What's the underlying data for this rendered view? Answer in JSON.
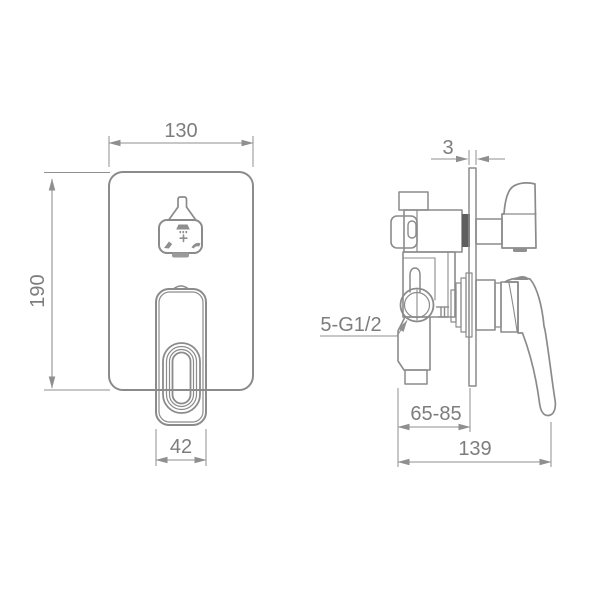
{
  "dimensions": {
    "plate_width": "130",
    "plate_height": "190",
    "handle_width": "42",
    "plate_thickness": "3",
    "inlet_thread": "5-G1/2",
    "mounting_depth": "65-85",
    "overall_depth": "139"
  },
  "icons": {
    "diverter_shower": "shower-head",
    "diverter_plus": "+",
    "diverter_spout_left": "spout",
    "diverter_spout_right": "spout"
  },
  "colors": {
    "line": "#8b8b8b",
    "dark_fill": "#5e5e5e",
    "text": "#7d7d7d",
    "background": "#ffffff"
  }
}
